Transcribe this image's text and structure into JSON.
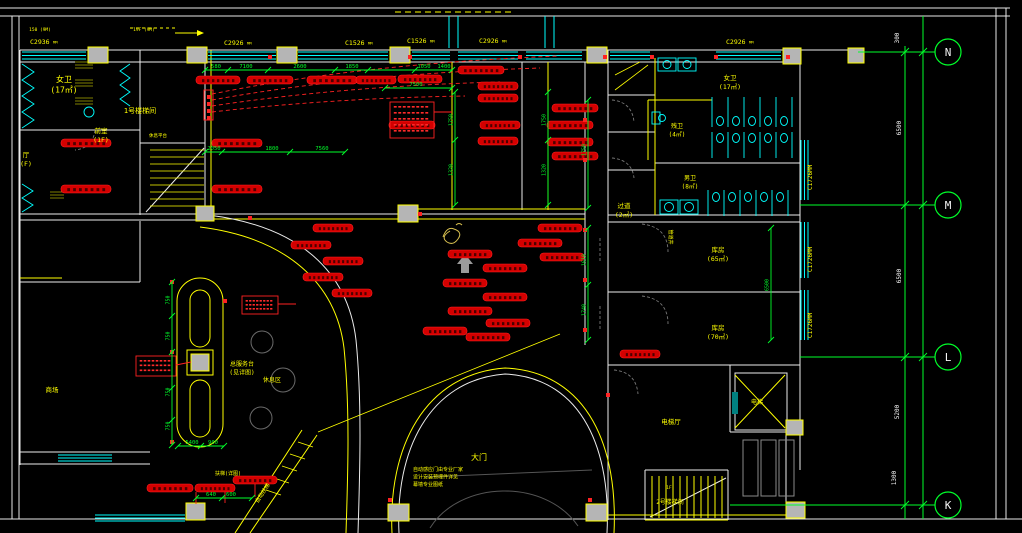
{
  "plan": {
    "colors": {
      "bg": "#000000",
      "wall": "#ececec",
      "accent_wall": "#ffff00",
      "window": "#00ffff",
      "dim": "#00ff2a",
      "device": "#d40000",
      "device_edge": "#ff2222",
      "column_fill": "#b5b5b5",
      "label_yellow": "#ffff00",
      "grid_text": "#f5f5f5",
      "olive": "#808000"
    },
    "window_suffix": "MM",
    "device_label_glyph": "▮▮▮▮▮▮▮",
    "note_glyph": "▪▪▪▪▪▪▪▪",
    "window_tags": {
      "h": [
        [
          "C2936",
          30,
          44
        ],
        [
          "C2926",
          224,
          45
        ],
        [
          "C1526",
          345,
          45
        ],
        [
          "C1526",
          407,
          43
        ],
        [
          "C2926",
          479,
          43
        ],
        [
          "C2926",
          726,
          44
        ]
      ],
      "v": [
        [
          "C1726",
          812,
          190
        ],
        [
          "C1726",
          812,
          272
        ],
        [
          "C1726",
          812,
          338
        ]
      ]
    },
    "labels": [
      {
        "t": [
          "女卫",
          "(17㎡)"
        ],
        "x": 64,
        "y": 82,
        "s": 8
      },
      {
        "t": [
          "前室",
          "(1F)"
        ],
        "x": 101,
        "y": 133,
        "s": 6.5
      },
      {
        "t": [
          "厅",
          "(F)"
        ],
        "x": 26,
        "y": 157,
        "s": 6.5
      },
      {
        "t": [
          "1号楼梯间"
        ],
        "x": 140,
        "y": 113,
        "s": 7
      },
      {
        "t": [
          "休息平台"
        ],
        "x": 158,
        "y": 137,
        "s": 4.5
      },
      {
        "t": [
          "过道",
          "(2㎡)"
        ],
        "x": 624,
        "y": 208,
        "s": 6.5
      },
      {
        "t": [
          "女卫",
          "(17㎡)"
        ],
        "x": 730,
        "y": 80,
        "s": 6.5
      },
      {
        "t": [
          "残卫",
          "(4㎡)"
        ],
        "x": 677,
        "y": 128,
        "s": 6
      },
      {
        "t": [
          "男卫",
          "(8㎡)"
        ],
        "x": 690,
        "y": 180,
        "s": 6
      },
      {
        "t": [
          "库房",
          "(65㎡)"
        ],
        "x": 718,
        "y": 252,
        "s": 6.5
      },
      {
        "t": [
          "库房",
          "(70㎡)"
        ],
        "x": 718,
        "y": 330,
        "s": 6.5
      },
      {
        "t": [
          "电梯厅"
        ],
        "x": 671,
        "y": 424,
        "s": 6.5
      },
      {
        "t": [
          "电梯"
        ],
        "x": 757,
        "y": 404,
        "s": 6
      },
      {
        "t": [
          "1F"
        ],
        "x": 669,
        "y": 489,
        "s": 4.5
      },
      {
        "t": [
          "2号楼梯间"
        ],
        "x": 670,
        "y": 504,
        "s": 6
      },
      {
        "t": [
          "大门"
        ],
        "x": 479,
        "y": 460,
        "s": 8
      },
      {
        "t": [
          "总服务台",
          "(见详图)"
        ],
        "x": 242,
        "y": 366,
        "s": 6
      },
      {
        "t": [
          "休息区"
        ],
        "x": 272,
        "y": 382,
        "s": 6
      },
      {
        "t": [
          "商场"
        ],
        "x": 52,
        "y": 392,
        "s": 6.5
      },
      {
        "t": [
          "自动扶梯"
        ],
        "x": 264,
        "y": 494,
        "s": 5.5,
        "r": -57
      },
      {
        "t": [
          "扶梯(详图)"
        ],
        "x": 228,
        "y": 475,
        "s": 5
      },
      {
        "t": [
          "自动感应门由专业厂家",
          "设计安装预埋件详见",
          "幕墙专业图纸"
        ],
        "x": 413,
        "y": 471,
        "s": 5,
        "a": "start"
      },
      {
        "t": [
          "150 (9M)"
        ],
        "x": 40,
        "y": 31,
        "s": 4.5
      },
      {
        "t": [
          "19F (9M)"
        ],
        "x": 144,
        "y": 31,
        "s": 4.5
      },
      {
        "t": [
          "管道井"
        ],
        "x": 669,
        "y": 237,
        "s": 5,
        "r": 90
      }
    ],
    "device_labels": [
      [
        218,
        80,
        44
      ],
      [
        270,
        80,
        46
      ],
      [
        332,
        80,
        50
      ],
      [
        376,
        80,
        40
      ],
      [
        420,
        79,
        44
      ],
      [
        481,
        70,
        46
      ],
      [
        498,
        86,
        40
      ],
      [
        498,
        98,
        40
      ],
      [
        500,
        125,
        40
      ],
      [
        498,
        141,
        40
      ],
      [
        412,
        125,
        46
      ],
      [
        575,
        108,
        46
      ],
      [
        570,
        125,
        46
      ],
      [
        570,
        142,
        46
      ],
      [
        575,
        156,
        46
      ],
      [
        86,
        143,
        50
      ],
      [
        86,
        189,
        50
      ],
      [
        237,
        143,
        50
      ],
      [
        237,
        189,
        50
      ],
      [
        560,
        228,
        44
      ],
      [
        540,
        243,
        44
      ],
      [
        562,
        257,
        44
      ],
      [
        470,
        254,
        44
      ],
      [
        505,
        268,
        44
      ],
      [
        465,
        283,
        44
      ],
      [
        505,
        297,
        44
      ],
      [
        470,
        311,
        44
      ],
      [
        508,
        323,
        44
      ],
      [
        445,
        331,
        44
      ],
      [
        488,
        337,
        44
      ],
      [
        333,
        228,
        40
      ],
      [
        311,
        245,
        40
      ],
      [
        343,
        261,
        40
      ],
      [
        323,
        277,
        40
      ],
      [
        352,
        293,
        40
      ],
      [
        640,
        354,
        40
      ],
      [
        170,
        488,
        46
      ],
      [
        215,
        488,
        40
      ],
      [
        255,
        480,
        44
      ]
    ],
    "device_dots": [
      [
        270,
        57
      ],
      [
        410,
        57
      ],
      [
        520,
        57
      ],
      [
        605,
        57
      ],
      [
        652,
        57
      ],
      [
        716,
        57
      ],
      [
        788,
        57
      ],
      [
        585,
        120
      ],
      [
        585,
        160
      ],
      [
        585,
        230
      ],
      [
        585,
        280
      ],
      [
        585,
        330
      ],
      [
        420,
        214
      ],
      [
        250,
        218
      ],
      [
        172,
        282
      ],
      [
        172,
        352
      ],
      [
        172,
        442
      ],
      [
        209,
        97
      ],
      [
        209,
        104
      ],
      [
        209,
        111
      ],
      [
        209,
        118
      ],
      [
        390,
        500
      ],
      [
        590,
        500
      ],
      [
        225,
        301
      ],
      [
        608,
        395
      ]
    ],
    "note_boxes": [
      {
        "x": 390,
        "y": 102,
        "w": 44,
        "h": 36,
        "n": 5
      },
      {
        "x": 242,
        "y": 296,
        "w": 36,
        "h": 18,
        "n": 3
      },
      {
        "x": 136,
        "y": 356,
        "w": 40,
        "h": 20,
        "n": 3
      }
    ],
    "h_dims": [
      {
        "y": 70,
        "x1": 205,
        "x2": 452,
        "ticks": [
          205,
          228,
          268,
          335,
          368,
          415,
          452
        ],
        "labels": [
          [
            "580",
            216
          ],
          [
            "7100",
            246
          ],
          [
            "2600",
            300
          ],
          [
            "1850",
            352
          ],
          [
            "1050",
            424
          ],
          [
            "1400",
            444
          ]
        ]
      },
      {
        "y": 88,
        "x1": 385,
        "x2": 452,
        "ticks": [
          385,
          452
        ],
        "labels": [
          [
            "7500",
            416
          ]
        ]
      },
      {
        "y": 152,
        "x1": 205,
        "x2": 345,
        "ticks": [
          205,
          222,
          290,
          345
        ],
        "labels": [
          [
            "2050",
            214
          ],
          [
            "1800",
            272
          ],
          [
            "7560",
            322
          ]
        ]
      },
      {
        "y": 446,
        "x1": 178,
        "x2": 224,
        "ticks": [
          178,
          201,
          224
        ],
        "labels": [
          [
            "5400",
            192
          ],
          [
            "900",
            213
          ]
        ]
      },
      {
        "y": 498,
        "x1": 196,
        "x2": 252,
        "ticks": [
          196,
          222,
          252
        ],
        "labels": [
          [
            "640",
            211
          ],
          [
            "600",
            231
          ]
        ]
      }
    ],
    "v_chains": [
      {
        "x": 455,
        "y1": 92,
        "y2": 205,
        "ticks": [
          92,
          140,
          205
        ],
        "labels": [
          [
            "1750",
            120
          ],
          [
            "1320",
            170
          ]
        ]
      },
      {
        "x": 548,
        "y1": 92,
        "y2": 205,
        "ticks": [
          92,
          140,
          205
        ],
        "labels": [
          [
            "1750",
            120
          ],
          [
            "1320",
            170
          ]
        ]
      },
      {
        "x": 588,
        "y1": 100,
        "y2": 208,
        "ticks": [
          100,
          208
        ],
        "labels": [
          [
            "1750",
            150
          ]
        ]
      },
      {
        "x": 588,
        "y1": 228,
        "y2": 340,
        "ticks": [
          228,
          285,
          340
        ],
        "labels": [
          [
            "1610",
            260
          ],
          [
            "1740",
            310
          ]
        ]
      },
      {
        "x": 172,
        "y1": 282,
        "y2": 445,
        "ticks": [
          282,
          316,
          352,
          388,
          420,
          445
        ],
        "labels": [
          [
            "750",
            300
          ],
          [
            "750",
            336
          ],
          [
            "750",
            392
          ],
          [
            "750",
            426
          ]
        ]
      },
      {
        "x": 771,
        "y1": 228,
        "y2": 340,
        "ticks": [
          228,
          340
        ],
        "labels": [
          [
            "6500",
            285
          ]
        ]
      }
    ],
    "grid": {
      "vx": [
        905,
        923
      ],
      "bubble_x": 948,
      "r": 13,
      "rows": [
        {
          "letter": "N",
          "y": 52,
          "x1": 858
        },
        {
          "letter": "M",
          "y": 205,
          "x1": 800
        },
        {
          "letter": "L",
          "y": 357,
          "x1": 800
        },
        {
          "letter": "K",
          "y": 505,
          "x1": 730
        }
      ],
      "dims": [
        [
          "300",
          899,
          38
        ],
        [
          "6500",
          901,
          128
        ],
        [
          "6500",
          901,
          276
        ],
        [
          "5200",
          899,
          412
        ],
        [
          "1300",
          896,
          478
        ]
      ]
    }
  }
}
